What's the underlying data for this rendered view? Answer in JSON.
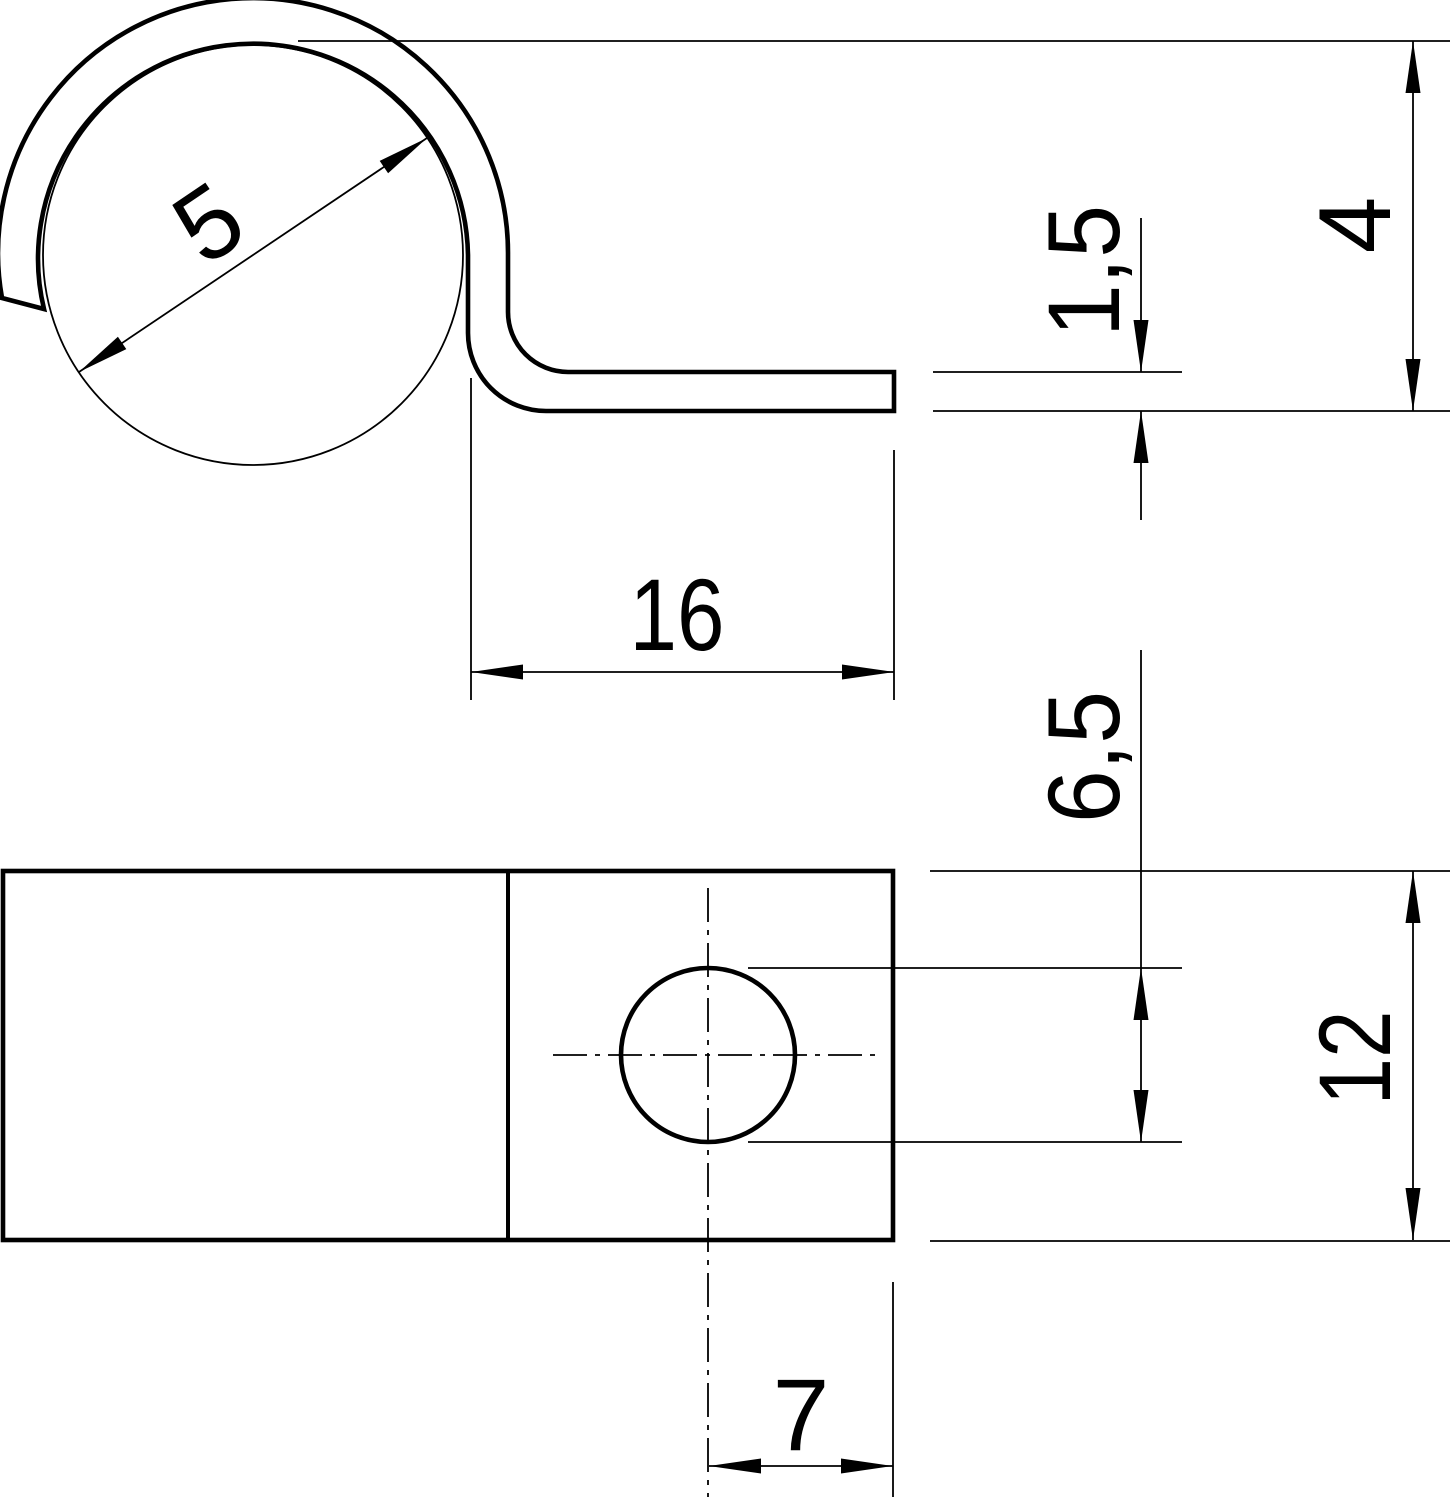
{
  "drawing": {
    "kind": "technical-dimension-drawing",
    "background_color": "#ffffff",
    "line_color": "#000000",
    "views": {
      "side_view": "clip profile with cable loop and flat foot",
      "plan_view": "mounting plate with hole"
    },
    "dimensions": {
      "cable_diameter": "5",
      "foot_length": "16",
      "material_thickness": "1,5",
      "clamp_height": "4",
      "hole_diameter": "6,5",
      "plate_width": "12",
      "hole_edge_distance": "7"
    }
  }
}
